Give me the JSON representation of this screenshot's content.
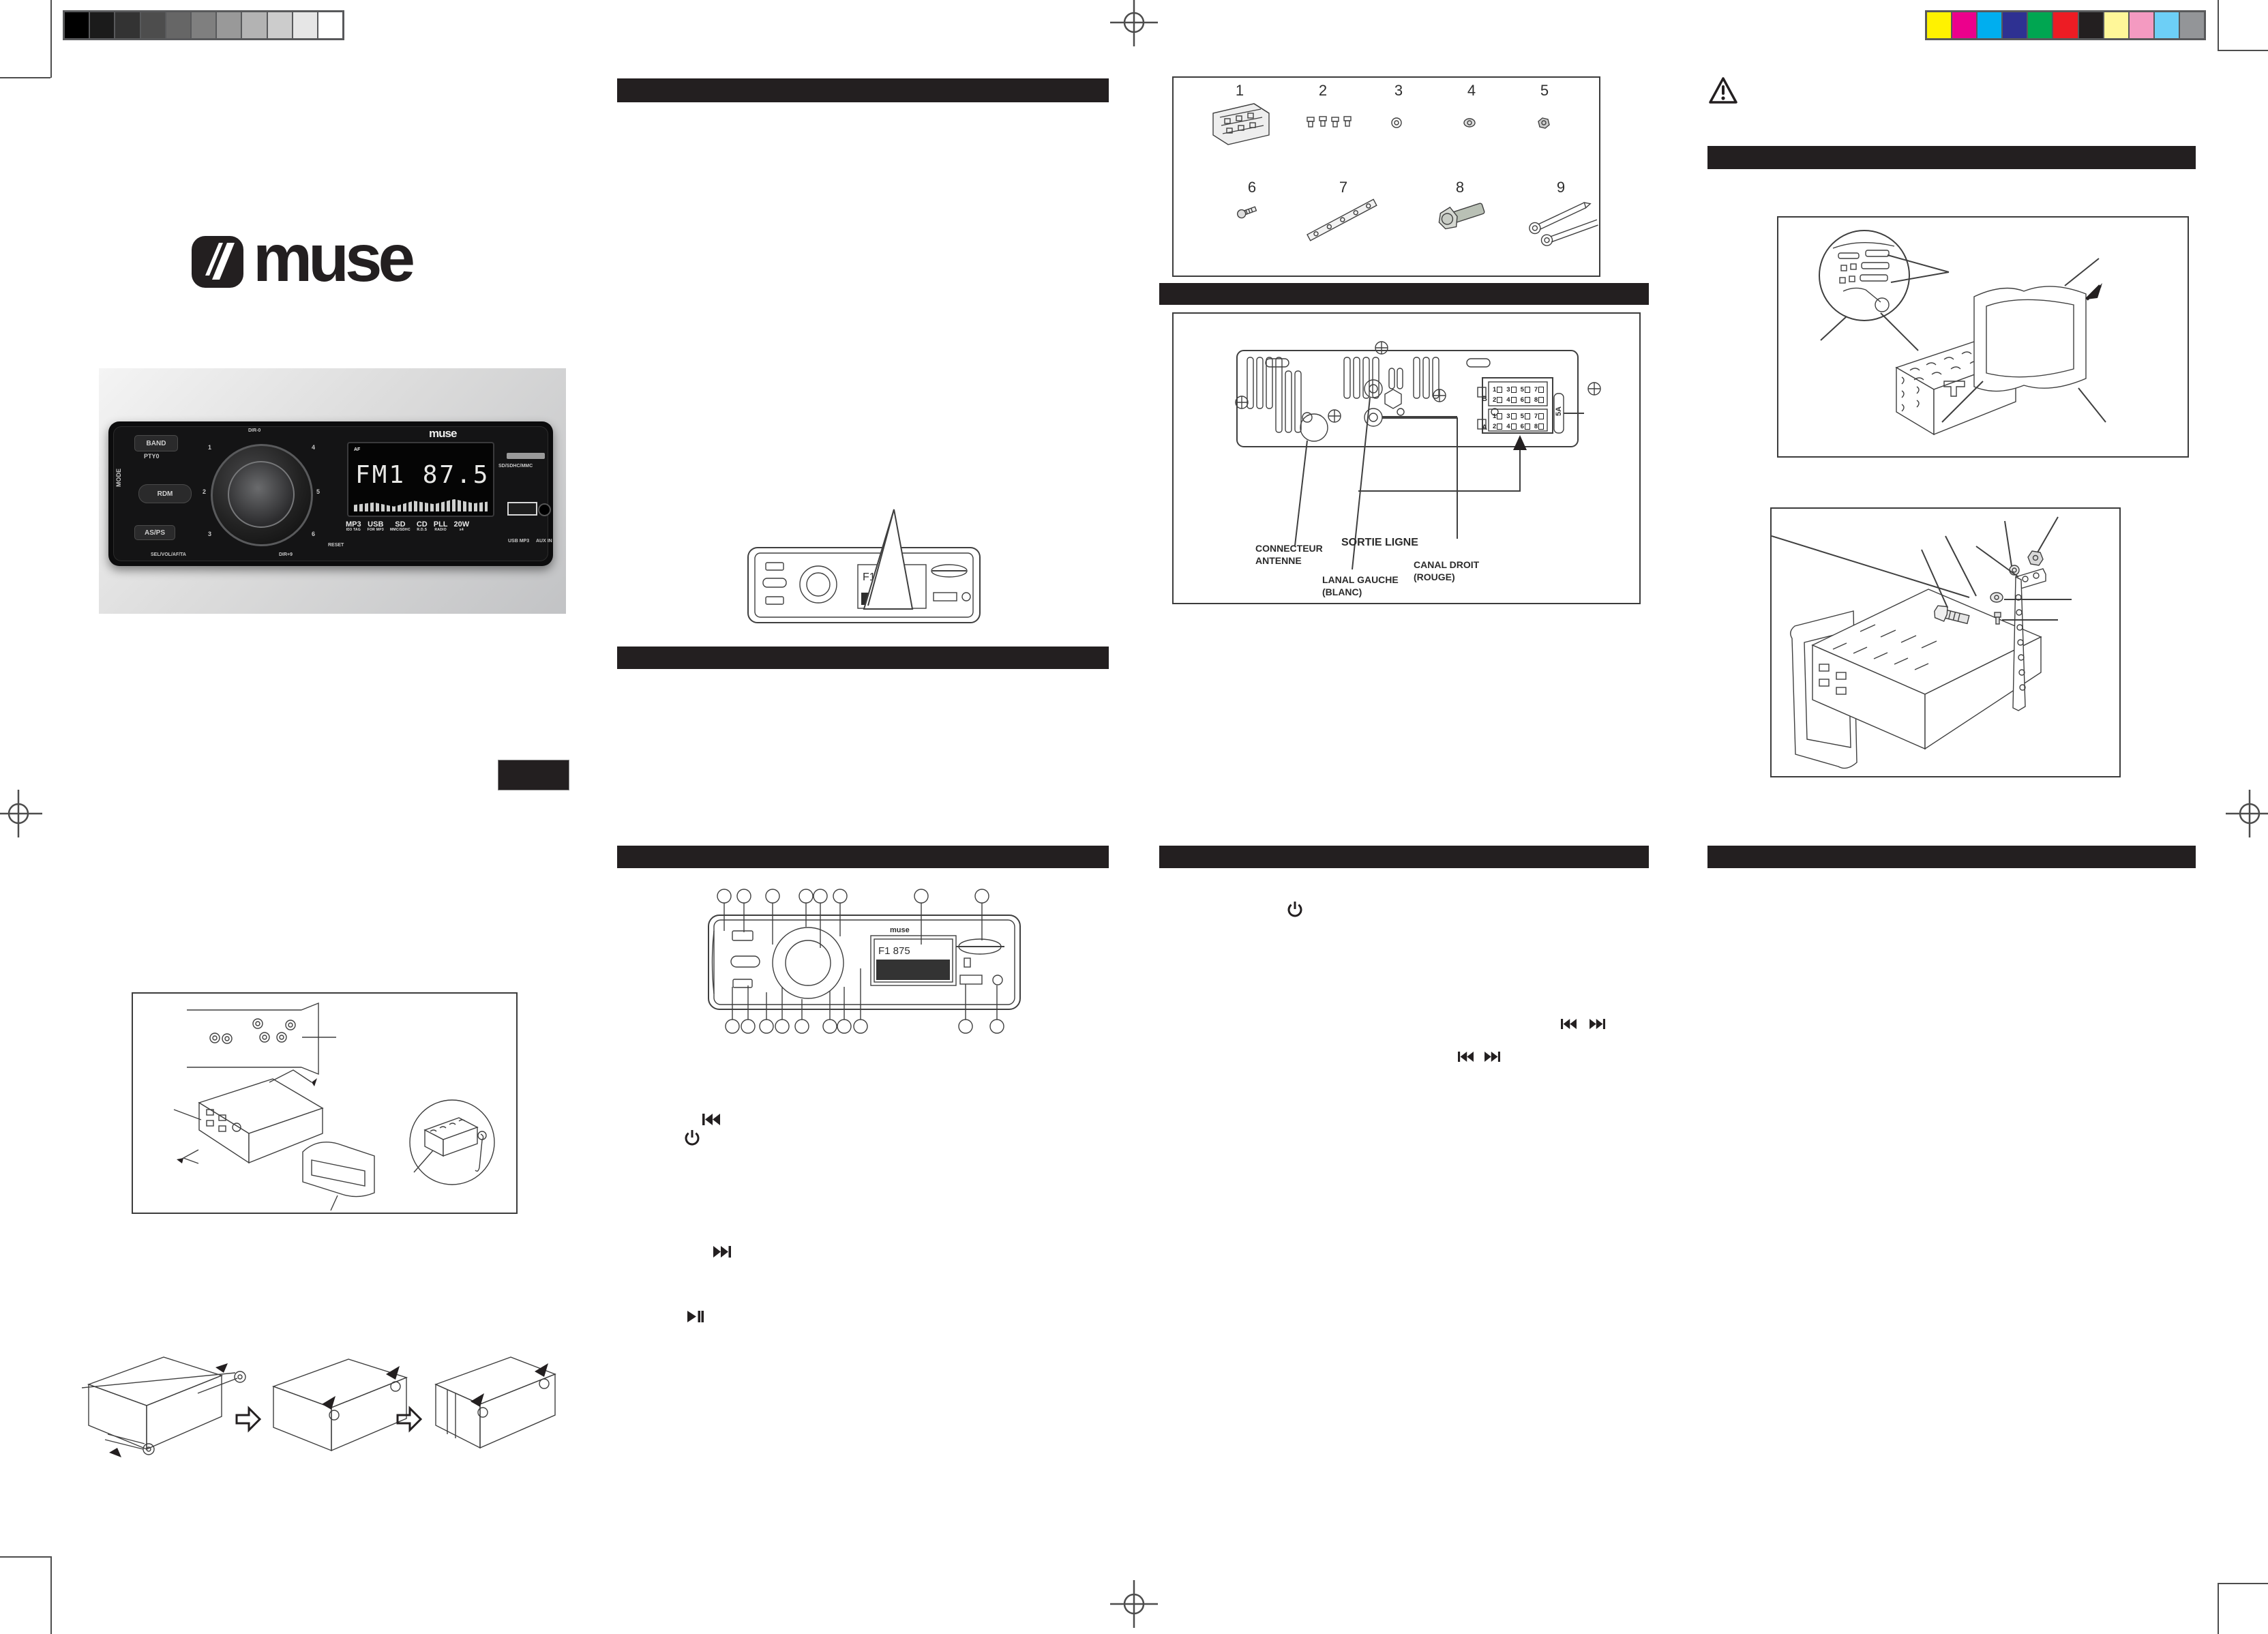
{
  "calibration": {
    "grayscale": [
      "#000000",
      "#1b1b1b",
      "#333333",
      "#4d4d4d",
      "#666666",
      "#7f7f7f",
      "#999999",
      "#b3b3b3",
      "#cccccc",
      "#e6e6e6",
      "#ffffff"
    ],
    "colors": [
      "#fff200",
      "#ec008c",
      "#00aeef",
      "#2e3192",
      "#00a651",
      "#ed1c24",
      "#231f20",
      "#fff799",
      "#f49ac1",
      "#6dcff6",
      "#939598"
    ]
  },
  "brand": {
    "logo_text": "muse"
  },
  "photo": {
    "logo": "muse",
    "display_small": "AF",
    "display_main": "FM1 87.5",
    "btn_band": "BAND",
    "btn_pty": "PTY0",
    "btn_mode": "MODE",
    "btn_rdm": "RDM",
    "btn_asps": "AS/PS",
    "presets": [
      "1",
      "2",
      "3",
      "4",
      "5",
      "6"
    ],
    "knob_top": "DIR-0",
    "knob_bottom": "DIR+9",
    "caption_sel": "SEL/VOL/AF/TA",
    "reset": "RESET",
    "badges": [
      [
        "MP3",
        "ID3 TAG"
      ],
      [
        "USB",
        "FOR MP3"
      ],
      [
        "SD",
        "MMC/SDHC"
      ],
      [
        "CD",
        "R.D.S"
      ],
      [
        "PLL",
        "RADIO"
      ],
      [
        "20W",
        "x4"
      ]
    ],
    "label_sd": "SD/SDHC/MMC",
    "label_usb": "USB MP3",
    "label_aux": "AUX IN"
  },
  "parts": {
    "numbers": [
      "1",
      "2",
      "3",
      "4",
      "5",
      "6",
      "7",
      "8",
      "9"
    ]
  },
  "wiring": {
    "antenna_l1": "CONNECTEUR",
    "antenna_l2": "ANTENNE",
    "line_out": "SORTIE LIGNE",
    "left_l1": "LANAL GAUCHE",
    "left_l2": "(BLANC)",
    "right_l1": "CANAL DROIT",
    "right_l2": "(ROUGE)",
    "fuse": "5A",
    "conn_b": "B",
    "conn_a": "A",
    "pins": [
      [
        "1",
        "3",
        "5",
        "7"
      ],
      [
        "2",
        "4",
        "6",
        "8"
      ],
      [
        "1",
        "3",
        "5",
        "7"
      ],
      [
        "2",
        "4",
        "6",
        "8"
      ]
    ]
  },
  "panel_diagram": {
    "logo": "muse",
    "display": "F1 875"
  },
  "mini_diagram": {
    "logo": "muse",
    "display": "F1 875"
  }
}
